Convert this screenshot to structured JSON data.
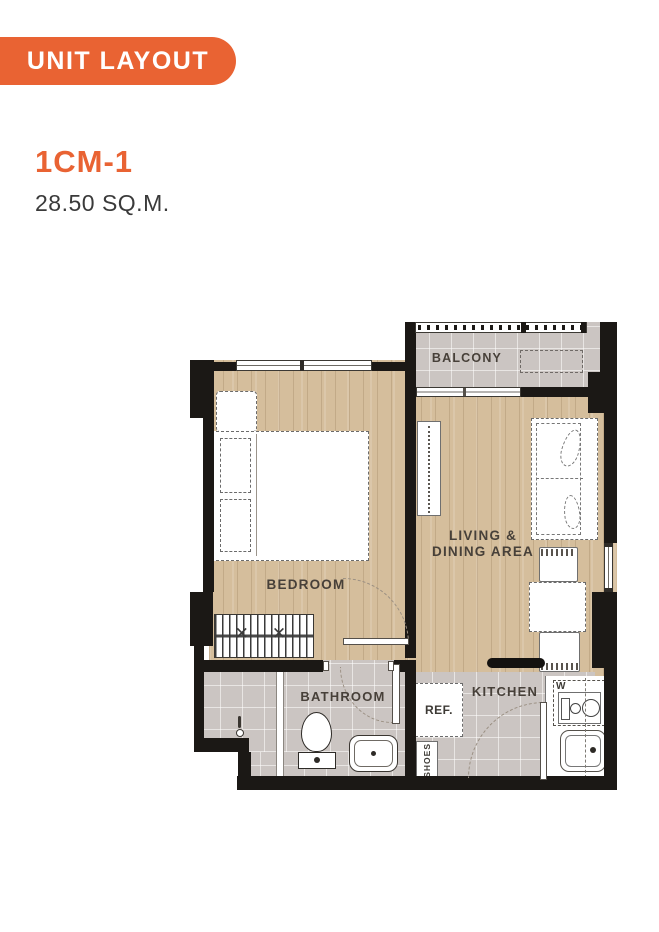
{
  "banner": {
    "label": "UNIT LAYOUT",
    "bg": "#E96333",
    "text_color": "#FFFFFF"
  },
  "unit": {
    "code": "1CM-1",
    "area": "28.50 SQ.M."
  },
  "floorplan": {
    "labels": {
      "balcony": "BALCONY",
      "bedroom": "BEDROOM",
      "living_line1": "LIVING &",
      "living_line2": "DINING AREA",
      "bathroom": "BATHROOM",
      "kitchen": "KITCHEN",
      "fridge": "REF.",
      "shoes": "SHOES",
      "washer": "W"
    },
    "colors": {
      "accent": "#E96333",
      "wall": "#1B1815",
      "wood_floor": "#D5BE9C",
      "tile_floor": "#CBC5C2",
      "label_text": "#474039",
      "furniture_outline": "#6B6B6B"
    }
  }
}
